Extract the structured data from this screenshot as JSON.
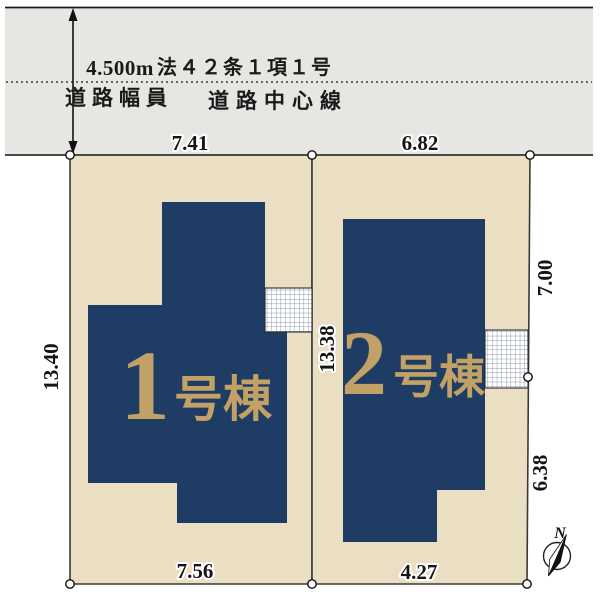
{
  "road": {
    "width_value": "4.500m",
    "law_reference": "法４２条１項１号",
    "width_caption": "道路幅員",
    "centerline_caption": "道路中心線"
  },
  "lot1": {
    "dim_top": "7.41",
    "dim_bottom": "7.56",
    "dim_left": "13.40",
    "building_number": "1",
    "building_suffix": "号棟"
  },
  "lot2": {
    "dim_top": "6.82",
    "dim_bottom": "4.27",
    "dim_left": "13.38",
    "dim_right_upper": "7.00",
    "dim_right_lower": "6.38",
    "building_number": "2",
    "building_suffix": "号棟"
  },
  "compass": {
    "north_label": "N"
  },
  "colors": {
    "road_fill": "#e7e6e3",
    "lot_fill": "#eadfc2",
    "building_fill": "#1e3c64",
    "building_label": "#c1a166",
    "line": "#3a3a35"
  }
}
